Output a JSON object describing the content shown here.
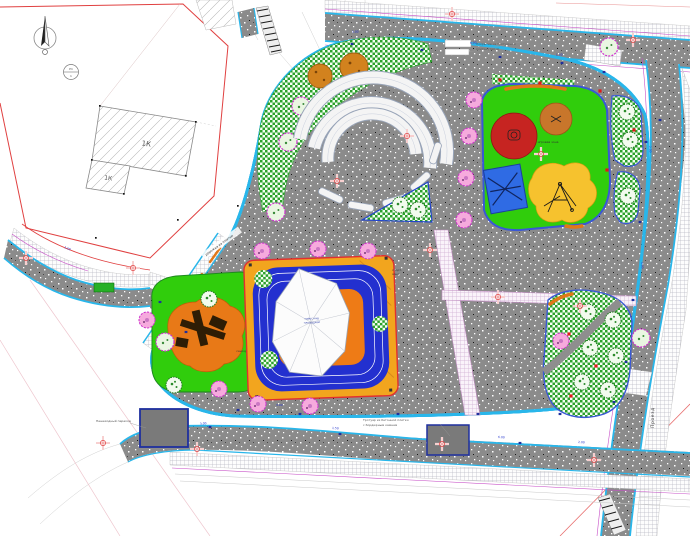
{
  "labels": {
    "building_block_a": "1К",
    "building_block_b": "1К",
    "road_vertical": "Проезд",
    "benchmark_top": "Рп",
    "benchmark_bottom": "1"
  },
  "annotations": {
    "top_callout_line1": "Покрытие из тротуарной",
    "top_callout_line2": "плитки (тип 1)",
    "bottom_callout_line1": "Тротуар из бетонной плитки",
    "bottom_callout_line2": "с бордюрным камнем",
    "left_callout": "Пешеходный переход",
    "diagonal_walk": "дорожка из плитки",
    "playground_right": "игровая зона",
    "sensory_path": "сенсорная дорожка",
    "canopy_line1": "навес над",
    "canopy_line2": "площадкой",
    "court_side_line1": "спорт.",
    "court_side_line2": "зона"
  },
  "dimensions": [
    "3.00",
    "6.00",
    "1.50",
    "2.00",
    "4.00",
    "3.00",
    "1.50",
    "6.00",
    "2.00",
    "3.00",
    "1.50",
    "3.00"
  ],
  "icons": {
    "north_arrow": "compass-needle",
    "benchmark": "survey-benchmark",
    "crosshair": "survey-cross",
    "tree_pink": "flowering-tree",
    "tree_green": "deciduous-tree"
  },
  "colors": {
    "curb_cyan": "#29b6ea",
    "boundary_red": "#e03030",
    "lawn_green": "#23a523",
    "rubber_green": "#35d60e",
    "track_blue": "#2330cf",
    "court_amber": "#f2a51e",
    "field_orange": "#ee7b16",
    "tree_pink": "#f6aadd",
    "utility_magenta": "#c74fc7",
    "paving_gray": "#8b8b8b",
    "platform_navy": "#1e2f9e"
  }
}
